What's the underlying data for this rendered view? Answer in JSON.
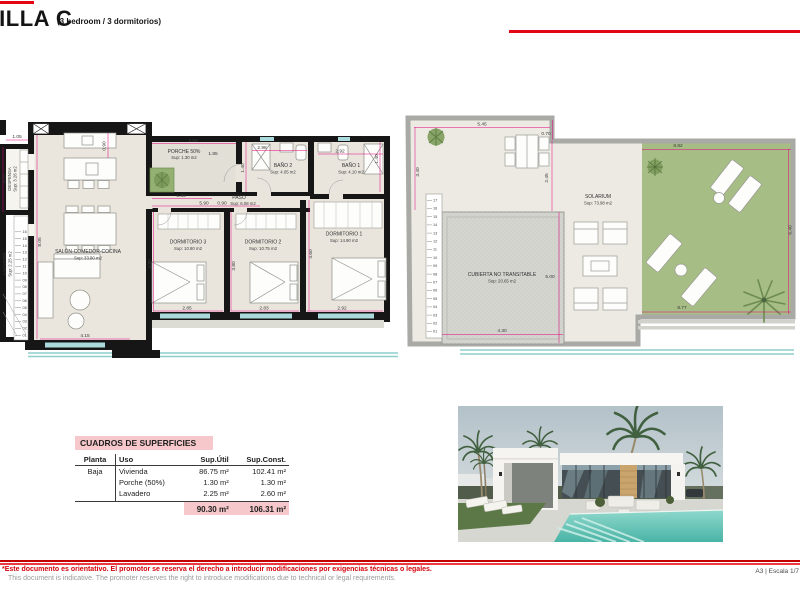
{
  "header": {
    "title": "VILLA C",
    "subtitle": "(3 bedroom / 3 dormitorios)"
  },
  "floor_plan": {
    "rooms": {
      "despensa": {
        "name": "DESPENSA",
        "area": "Sup: 3.26 m2"
      },
      "lavadero": {
        "name": "LAVADERO",
        "area": "Sup: 2.25 m2"
      },
      "salon": {
        "name": "SALÓN-COMEDOR-COCINA",
        "area": "Sup: 33.80 m2"
      },
      "porche": {
        "name": "PORCHE 50%",
        "area": "Sup: 1.30 m2"
      },
      "paso": {
        "name": "PASO",
        "area": "Sup: 6.08 m2"
      },
      "bano2": {
        "name": "BAÑO 2",
        "area": "Sup: 4.05 m2"
      },
      "bano1": {
        "name": "BAÑO 1",
        "area": "Sup: 4.10 m2"
      },
      "dormitorio3": {
        "name": "DORMITORIO 3",
        "area": "Sup: 10.80 m2"
      },
      "dormitorio2": {
        "name": "DORMITORIO 2",
        "area": "Sup: 10.75 m2"
      },
      "dormitorio1": {
        "name": "DORMITORIO 1",
        "area": "Sup: 14.90 m2"
      }
    },
    "dims": {
      "d105": "1.05",
      "d310": "3.10",
      "d805": "8.05",
      "d090k": "0.90",
      "d415": "4.15",
      "d250": "2.50",
      "d185": "1.85",
      "d135": "1.35",
      "d298": "2.98",
      "d140b2": "1.40",
      "d292b1": "2.92",
      "d140b1": "1.40",
      "d090p": "0.90",
      "d590": "5.90",
      "d380d3": "3.80",
      "d285": "2.85",
      "d380d2": "3.80",
      "d283": "2.83",
      "d460": "4.60",
      "d292d1": "2.92"
    },
    "stairs": [
      "16",
      "15",
      "14",
      "13",
      "12",
      "11",
      "10",
      "09",
      "08",
      "07",
      "06",
      "05",
      "04",
      "03",
      "02",
      "01"
    ]
  },
  "roof_plan": {
    "rooms": {
      "solarium": {
        "name": "SOLARIUM",
        "area": "Sup: 73.98 m2"
      },
      "cubierta": {
        "name": "CUBIERTA NO TRANSITABLE",
        "area": "Sup: 20.65 m2"
      }
    },
    "dims": {
      "d545": "5.45",
      "d070": "0.70",
      "d340": "3.40",
      "d245": "2.45",
      "d882": "8.82",
      "d640": "6.40",
      "d877": "8.77",
      "d430": "4.30",
      "d500": "5.00"
    },
    "stairs": [
      "17",
      "16",
      "15",
      "14",
      "13",
      "12",
      "11",
      "10",
      "09",
      "08",
      "07",
      "06",
      "05",
      "04",
      "03",
      "02",
      "01"
    ]
  },
  "areas_table": {
    "title": "CUADROS DE SUPERFICIES",
    "columns": [
      "Planta",
      "Uso",
      "Sup.Útil",
      "Sup.Const."
    ],
    "rows": [
      {
        "planta": "Baja",
        "uso": "Vivienda",
        "util": "86.75 m²",
        "constr": "102.41 m²"
      },
      {
        "planta": "",
        "uso": "Porche (50%)",
        "util": "1.30 m²",
        "constr": "1.30 m²"
      },
      {
        "planta": "",
        "uso": "Lavadero",
        "util": "2.25 m²",
        "constr": "2.60 m²"
      }
    ],
    "total": {
      "util": "90.30 m²",
      "constr": "106.31 m²"
    }
  },
  "footer": {
    "disclaimer_es": "*Este documento es orientativo. El promotor se reserva el derecho a introducir modificaciones por exigencias técnicas o legales.",
    "disclaimer_en": "This document is indicative. The promoter reserves the right to introduce modifications due to technical or legal requirements.",
    "sheet_info": "A3 | Escala 1/7"
  },
  "colors": {
    "accent_red": "#e30613",
    "dim_magenta": "#e6007e",
    "table_pink": "#f6c8cb",
    "grass_green": "#a7bd86",
    "pool_teal": "#8fcfcb"
  }
}
